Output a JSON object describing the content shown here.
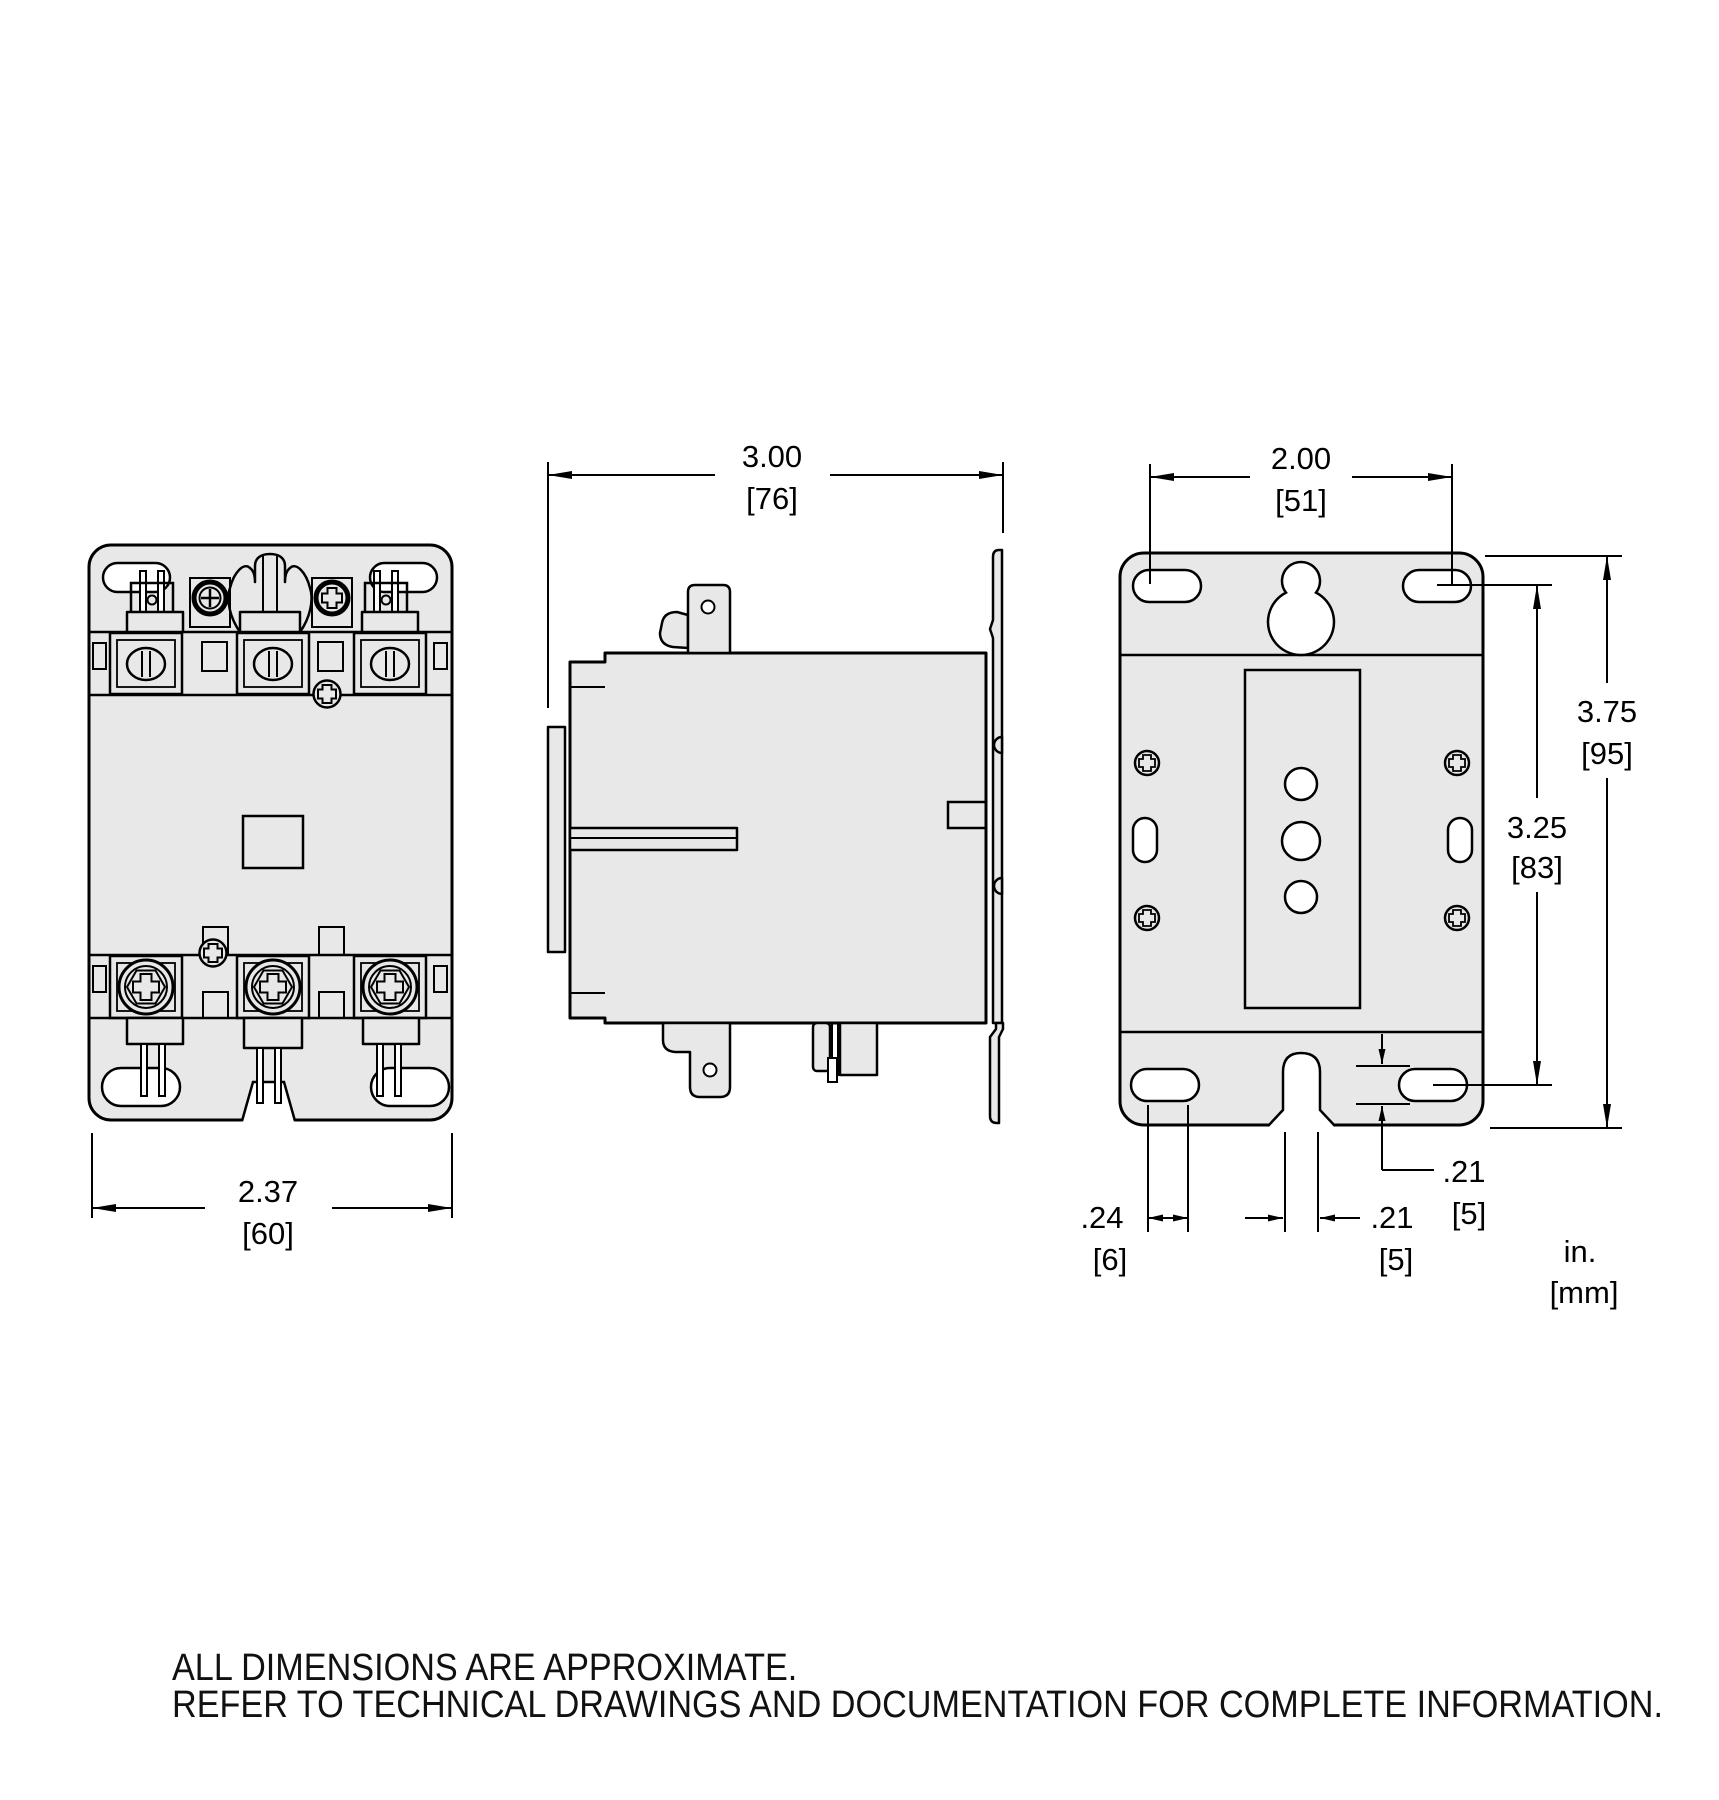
{
  "drawing": {
    "dims": {
      "side_width": {
        "in": "3.00",
        "mm": "[76]"
      },
      "back_hole_spacing_h": {
        "in": "2.00",
        "mm": "[51]"
      },
      "front_width": {
        "in": "2.37",
        "mm": "[60]"
      },
      "back_height": {
        "in": "3.75",
        "mm": "[95]"
      },
      "back_hole_spacing_v": {
        "in": "3.25",
        "mm": "[83]"
      },
      "slot_width": {
        "in": ".24",
        "mm": "[6]"
      },
      "notch_width": {
        "in": ".21",
        "mm": "[5]"
      },
      "slot_height": {
        "in": ".21",
        "mm": "[5]"
      }
    },
    "legend": {
      "units_primary": "in.",
      "units_secondary": "[mm]"
    },
    "notes": {
      "line1": "ALL DIMENSIONS ARE APPROXIMATE.",
      "line2": "REFER TO TECHNICAL DRAWINGS AND DOCUMENTATION FOR COMPLETE INFORMATION."
    },
    "colors": {
      "part_fill": "#e8e8e8",
      "line": "#000000",
      "cutout_fill": "#ffffff",
      "background": "#ffffff"
    }
  }
}
